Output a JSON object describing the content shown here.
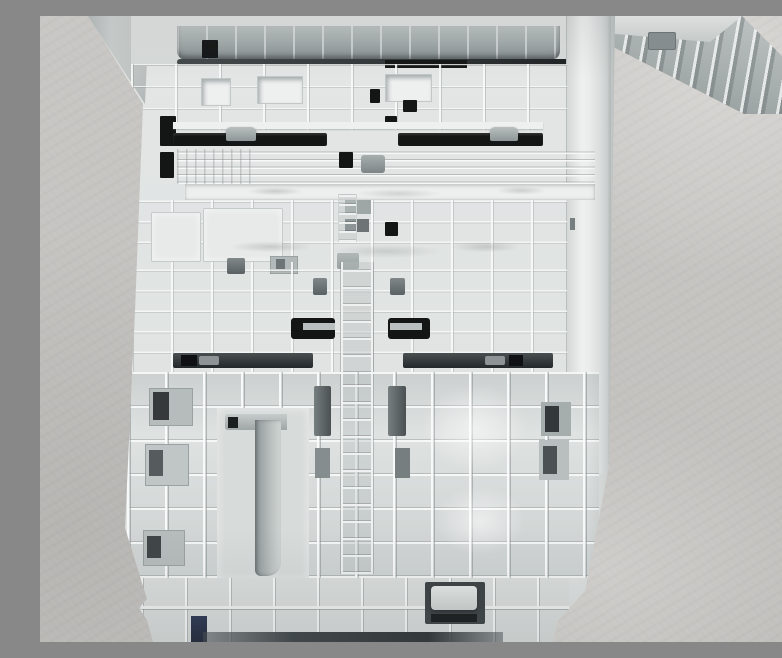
{
  "scene": {
    "description": "Top-down photograph of a light gray molded-plastic printer paper tray cassette lying on a neutral gray textured surface. The underside/inner frame shows a dense grid of stiffening ribs, a darker ribbed roller edge along the top, two long black guide slots with gray slider tabs, black C-shaped lock slots, dark latch recesses, a hook-shaped channel in the lower left, a recessed handle pocket near the bottom, and a small dark blue accent at the bottom edge. A gray ribbed mounting bracket protrudes past the top-right corner onto the backdrop.",
    "surface": "neutral gray textured backdrop",
    "objects": [
      {
        "name": "paper-tray-cassette",
        "material": "light gray molded plastic"
      },
      {
        "name": "mounting-bracket",
        "material": "gray ribbed plastic"
      }
    ]
  },
  "colors": {
    "background": "#c9c7c4",
    "background_light": "#d9d7d4",
    "background_shade": "#b7b5b2",
    "tray_base": "#e3e6e5",
    "rib_highlight": "#f4f6f5",
    "recess": "#c2c8c8",
    "recess_deep": "#aab1b2",
    "mid_gray": "#8f9697",
    "dark_gray": "#5a6163",
    "roller_gray": "#a6adad",
    "slot_black": "#141616",
    "shadow_dark": "#3c4143",
    "navy_accent": "#2b3550",
    "bracket_gray": "#aab1b0"
  }
}
